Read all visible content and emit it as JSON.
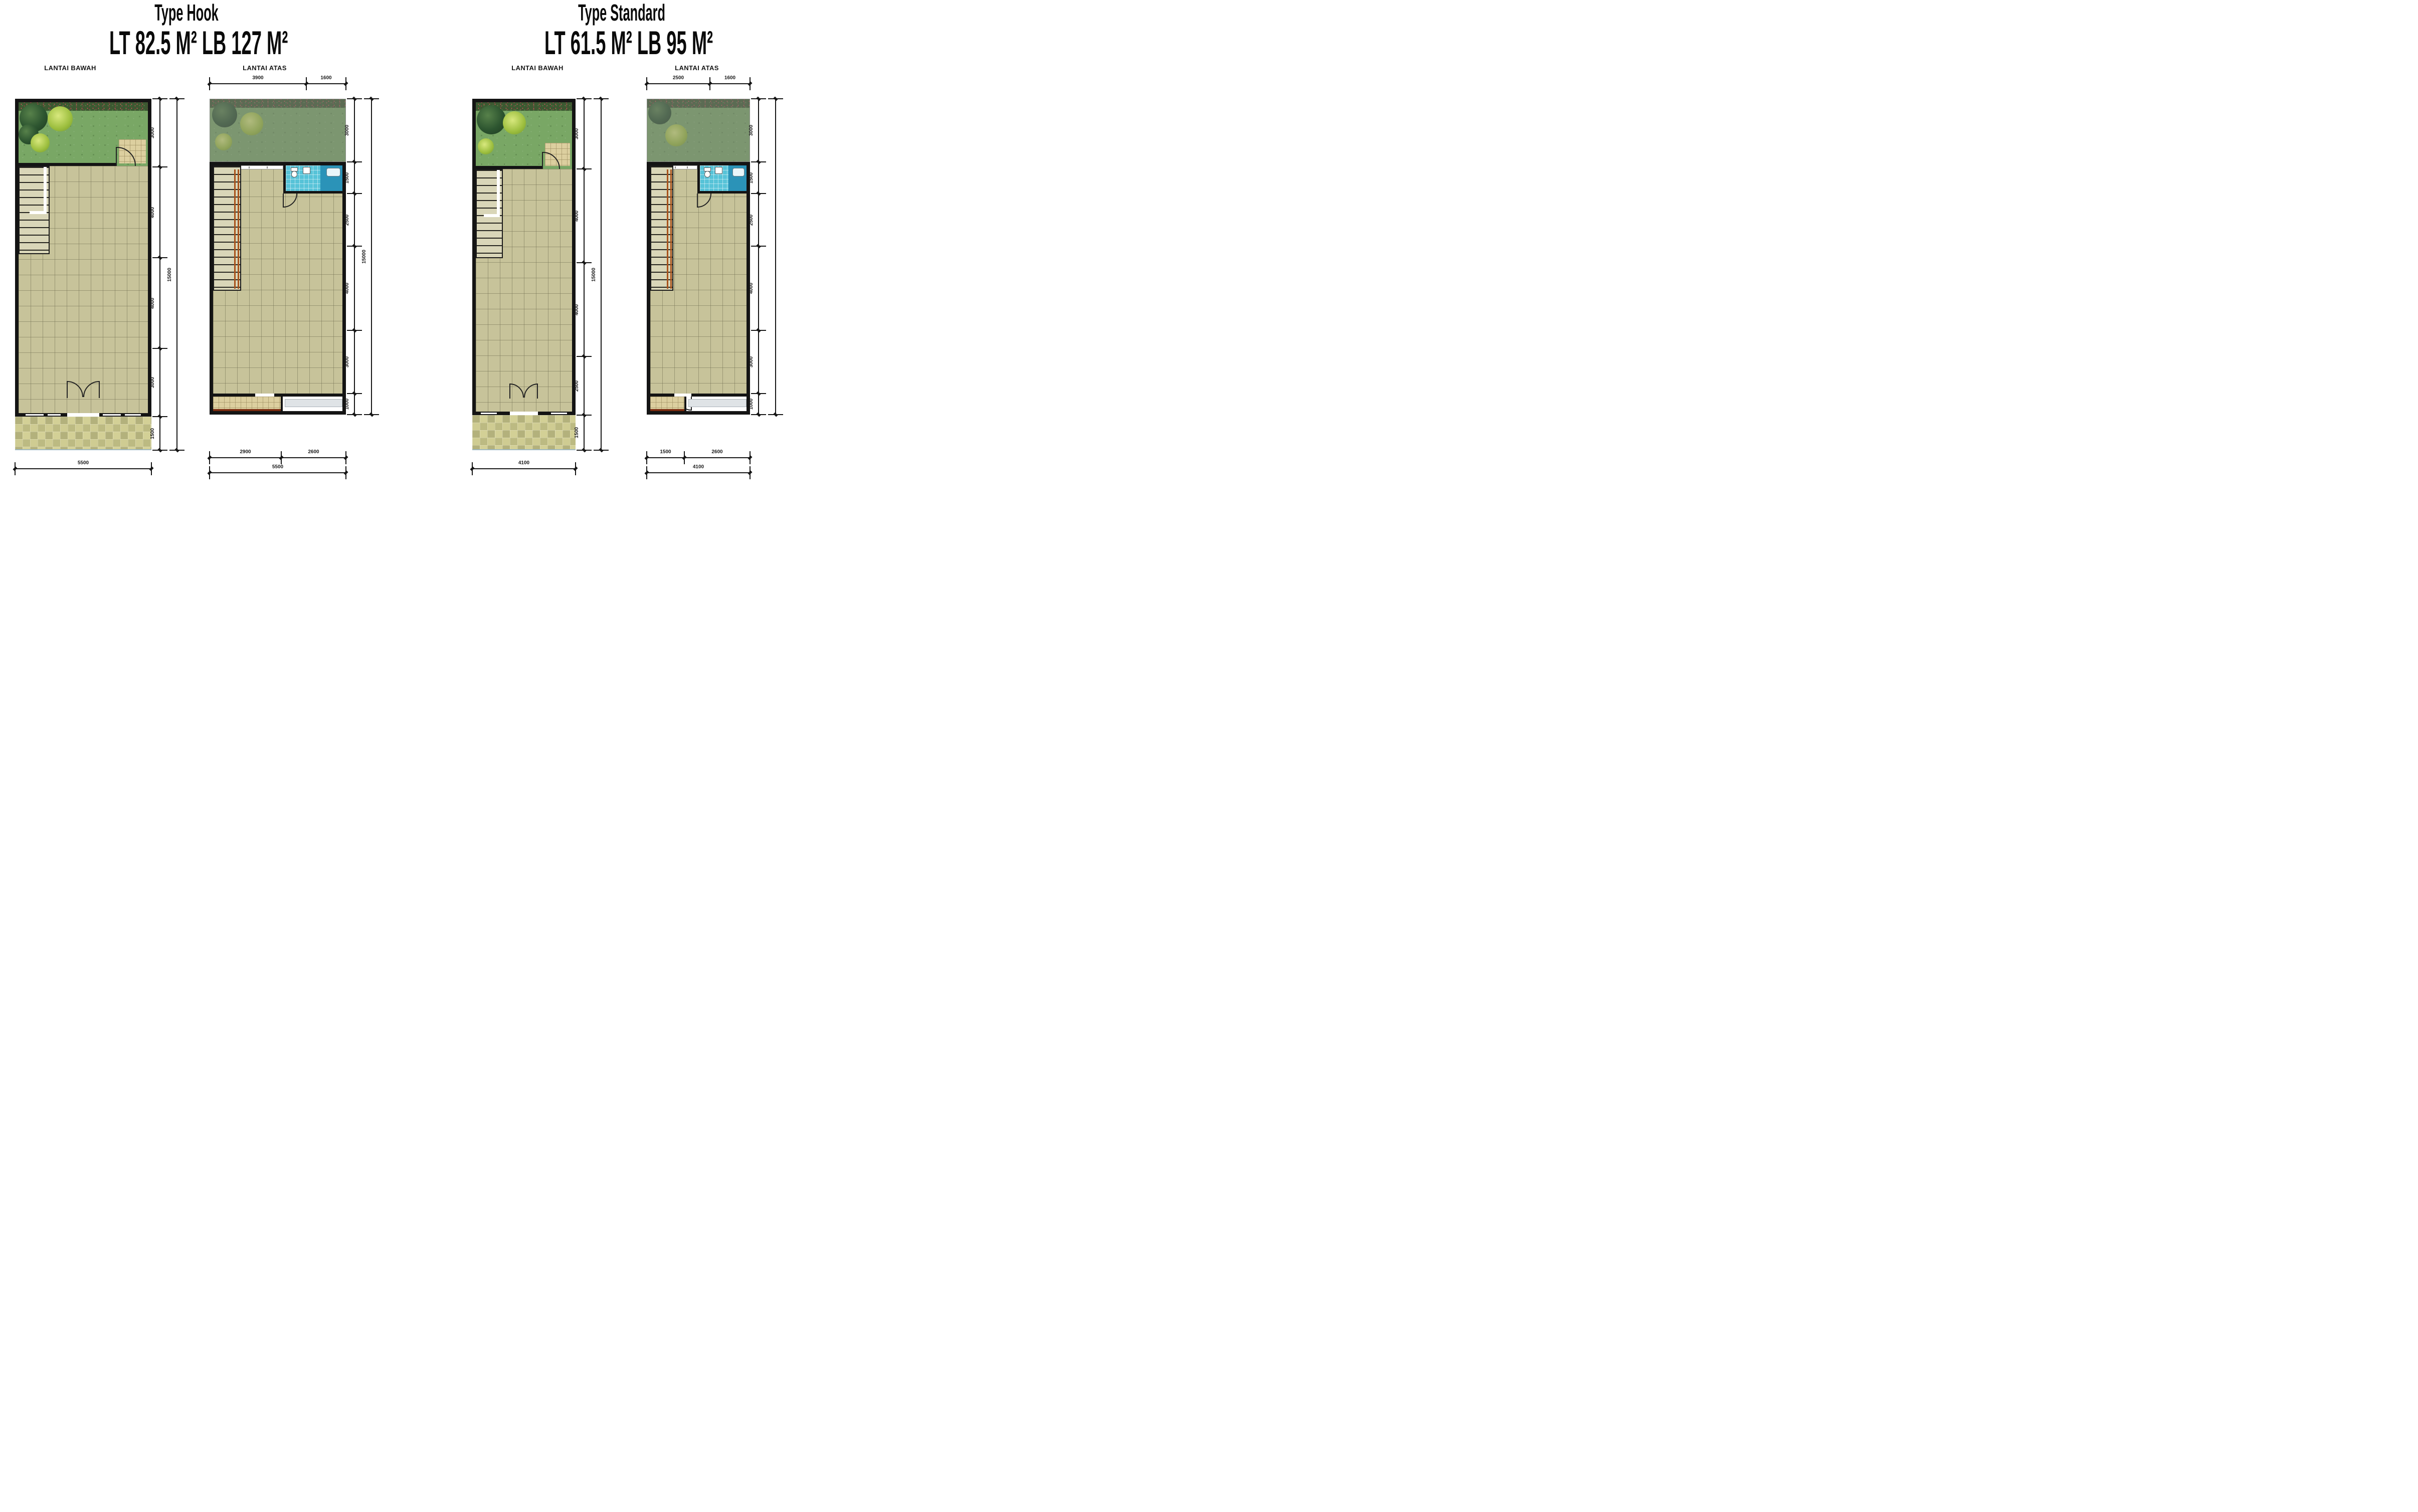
{
  "page": {
    "background": "#ffffff"
  },
  "colors": {
    "wall": "#141414",
    "tile": "#c7c39a",
    "grass": "#79a765",
    "bathroom_tile": "#57c3d8",
    "balcony_band": "#7a2c10"
  },
  "hook": {
    "title": "Type Hook",
    "area": "LT 82.5 M² LB 127 M²",
    "bawah": {
      "label": "LANTAI BAWAH",
      "right_dims": [
        "3000",
        "4000",
        "4000",
        "3000",
        "1500"
      ],
      "right_total": "15000",
      "bottom_total": "5500"
    },
    "atas": {
      "label": "LANTAI ATAS",
      "top_dims": [
        "3900",
        "1600"
      ],
      "right_dims": [
        "3000",
        "1500",
        "2500",
        "4000",
        "3000",
        "1000"
      ],
      "right_total": "15000",
      "bottom_dims": [
        "2900",
        "2600"
      ],
      "bottom_total": "5500"
    }
  },
  "standard": {
    "title": "Type Standard",
    "area": "LT 61.5 M² LB 95 M²",
    "bawah": {
      "label": "LANTAI BAWAH",
      "right_dims": [
        "3000",
        "4000",
        "4000",
        "2500",
        "1500"
      ],
      "right_total": "15000",
      "bottom_total": "4100"
    },
    "atas": {
      "label": "LANTAI ATAS",
      "top_dims": [
        "2500",
        "1600"
      ],
      "right_dims": [
        "3000",
        "1500",
        "2500",
        "4000",
        "3000",
        "1000"
      ],
      "bottom_dims": [
        "1500",
        "2600"
      ],
      "bottom_total": "4100"
    }
  }
}
